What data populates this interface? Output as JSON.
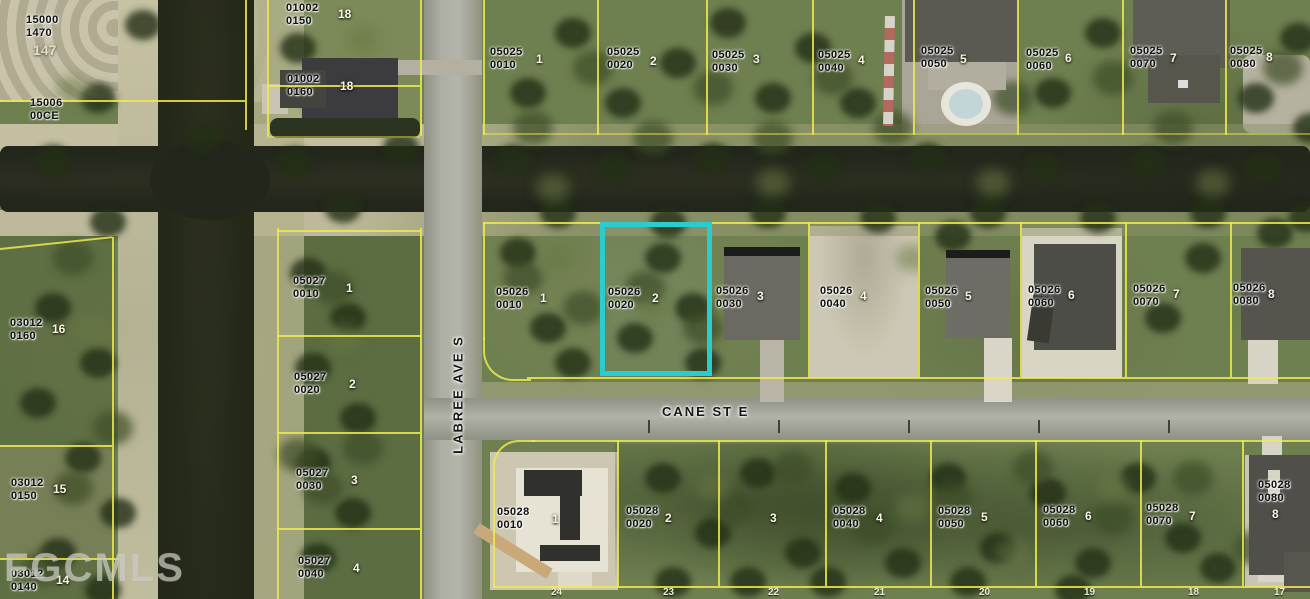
{
  "map": {
    "type": "aerial-parcel-map",
    "streets": {
      "labree": "LABREE AVE S",
      "cane": "CANE ST E"
    },
    "watermark": "FGCMLS",
    "highlight": {
      "parcel": "05026 0020",
      "lot": "2",
      "color": "#2accce"
    },
    "colors": {
      "parcel_line": "#eeea4e",
      "highlight": "#2accce",
      "label_text": "#101010",
      "lot_number_text": "#fbf6e0"
    },
    "parcel_labels": [
      {
        "l1": "15000",
        "l2": "1470",
        "x": 26,
        "y": 14,
        "lot": "147",
        "lotx": 33,
        "loty": 42,
        "faint": true
      },
      {
        "l1": "15006",
        "l2": "00CE",
        "x": 30,
        "y": 97
      },
      {
        "l1": "01002",
        "l2": "0150",
        "x": 286,
        "y": 2,
        "lot": "18",
        "lotx": 338,
        "loty": 7
      },
      {
        "l1": "01002",
        "l2": "0160",
        "x": 287,
        "y": 73,
        "lot": "18",
        "lotx": 340,
        "loty": 79
      },
      {
        "l1": "03012",
        "l2": "0160",
        "x": 10,
        "y": 317,
        "lot": "16",
        "lotx": 52,
        "loty": 322
      },
      {
        "l1": "03012",
        "l2": "0150",
        "x": 11,
        "y": 477,
        "lot": "15",
        "lotx": 53,
        "loty": 482
      },
      {
        "l1": "03012",
        "l2": "0140",
        "x": 11,
        "y": 568,
        "lot": "14",
        "lotx": 56,
        "loty": 573
      },
      {
        "l1": "05027",
        "l2": "0010",
        "x": 293,
        "y": 275,
        "lot": "1",
        "lotx": 346,
        "loty": 281
      },
      {
        "l1": "05027",
        "l2": "0020",
        "x": 294,
        "y": 371,
        "lot": "2",
        "lotx": 349,
        "loty": 377
      },
      {
        "l1": "05027",
        "l2": "0030",
        "x": 296,
        "y": 467,
        "lot": "3",
        "lotx": 351,
        "loty": 473
      },
      {
        "l1": "05027",
        "l2": "0040",
        "x": 298,
        "y": 555,
        "lot": "4",
        "lotx": 353,
        "loty": 561
      },
      {
        "l1": "05025",
        "l2": "0010",
        "x": 490,
        "y": 46,
        "lot": "1",
        "lotx": 536,
        "loty": 52
      },
      {
        "l1": "05025",
        "l2": "0020",
        "x": 607,
        "y": 46,
        "lot": "2",
        "lotx": 650,
        "loty": 54
      },
      {
        "l1": "05025",
        "l2": "0030",
        "x": 712,
        "y": 49,
        "lot": "3",
        "lotx": 753,
        "loty": 52
      },
      {
        "l1": "05025",
        "l2": "0040",
        "x": 818,
        "y": 49,
        "lot": "4",
        "lotx": 858,
        "loty": 53
      },
      {
        "l1": "05025",
        "l2": "0050",
        "x": 921,
        "y": 45,
        "lot": "5",
        "lotx": 960,
        "loty": 52
      },
      {
        "l1": "05025",
        "l2": "0060",
        "x": 1026,
        "y": 47,
        "lot": "6",
        "lotx": 1065,
        "loty": 51
      },
      {
        "l1": "05025",
        "l2": "0070",
        "x": 1130,
        "y": 45,
        "lot": "7",
        "lotx": 1170,
        "loty": 51
      },
      {
        "l1": "05025",
        "l2": "0080",
        "x": 1230,
        "y": 45,
        "lot": "8",
        "lotx": 1266,
        "loty": 50
      },
      {
        "l1": "05026",
        "l2": "0010",
        "x": 496,
        "y": 286,
        "lot": "1",
        "lotx": 540,
        "loty": 291
      },
      {
        "l1": "05026",
        "l2": "0020",
        "x": 608,
        "y": 286,
        "lot": "2",
        "lotx": 652,
        "loty": 291
      },
      {
        "l1": "05026",
        "l2": "0030",
        "x": 716,
        "y": 285,
        "lot": "3",
        "lotx": 757,
        "loty": 289
      },
      {
        "l1": "05026",
        "l2": "0040",
        "x": 820,
        "y": 285,
        "lot": "4",
        "lotx": 860,
        "loty": 289
      },
      {
        "l1": "05026",
        "l2": "0050",
        "x": 925,
        "y": 285,
        "lot": "5",
        "lotx": 965,
        "loty": 289
      },
      {
        "l1": "05026",
        "l2": "0060",
        "x": 1028,
        "y": 284,
        "lot": "6",
        "lotx": 1068,
        "loty": 288
      },
      {
        "l1": "05026",
        "l2": "0070",
        "x": 1133,
        "y": 283,
        "lot": "7",
        "lotx": 1173,
        "loty": 287
      },
      {
        "l1": "05026",
        "l2": "0080",
        "x": 1233,
        "y": 282,
        "lot": "8",
        "lotx": 1268,
        "loty": 287
      },
      {
        "l1": "05028",
        "l2": "0010",
        "x": 497,
        "y": 506,
        "lot": "1",
        "lotx": 552,
        "loty": 512
      },
      {
        "l1": "05028",
        "l2": "0020",
        "x": 626,
        "y": 505,
        "lot": "2",
        "lotx": 665,
        "loty": 511
      },
      {
        "lot": "3",
        "lotx": 770,
        "loty": 511
      },
      {
        "l1": "05028",
        "l2": "0040",
        "x": 833,
        "y": 505,
        "lot": "4",
        "lotx": 876,
        "loty": 511
      },
      {
        "l1": "05028",
        "l2": "0050",
        "x": 938,
        "y": 505,
        "lot": "5",
        "lotx": 981,
        "loty": 510
      },
      {
        "l1": "05028",
        "l2": "0060",
        "x": 1043,
        "y": 504,
        "lot": "6",
        "lotx": 1085,
        "loty": 509
      },
      {
        "l1": "05028",
        "l2": "0070",
        "x": 1146,
        "y": 502,
        "lot": "7",
        "lotx": 1189,
        "loty": 509
      },
      {
        "l1": "05028",
        "l2": "0080",
        "x": 1258,
        "y": 479,
        "lot": "8",
        "lotx": 1272,
        "loty": 507
      }
    ],
    "bottom_lot_numbers": [
      {
        "x": 551,
        "t": "24"
      },
      {
        "x": 663,
        "t": "23"
      },
      {
        "x": 768,
        "t": "22"
      },
      {
        "x": 874,
        "t": "21"
      },
      {
        "x": 979,
        "t": "20"
      },
      {
        "x": 1084,
        "t": "19"
      },
      {
        "x": 1188,
        "t": "18"
      },
      {
        "x": 1274,
        "t": "17"
      }
    ]
  }
}
